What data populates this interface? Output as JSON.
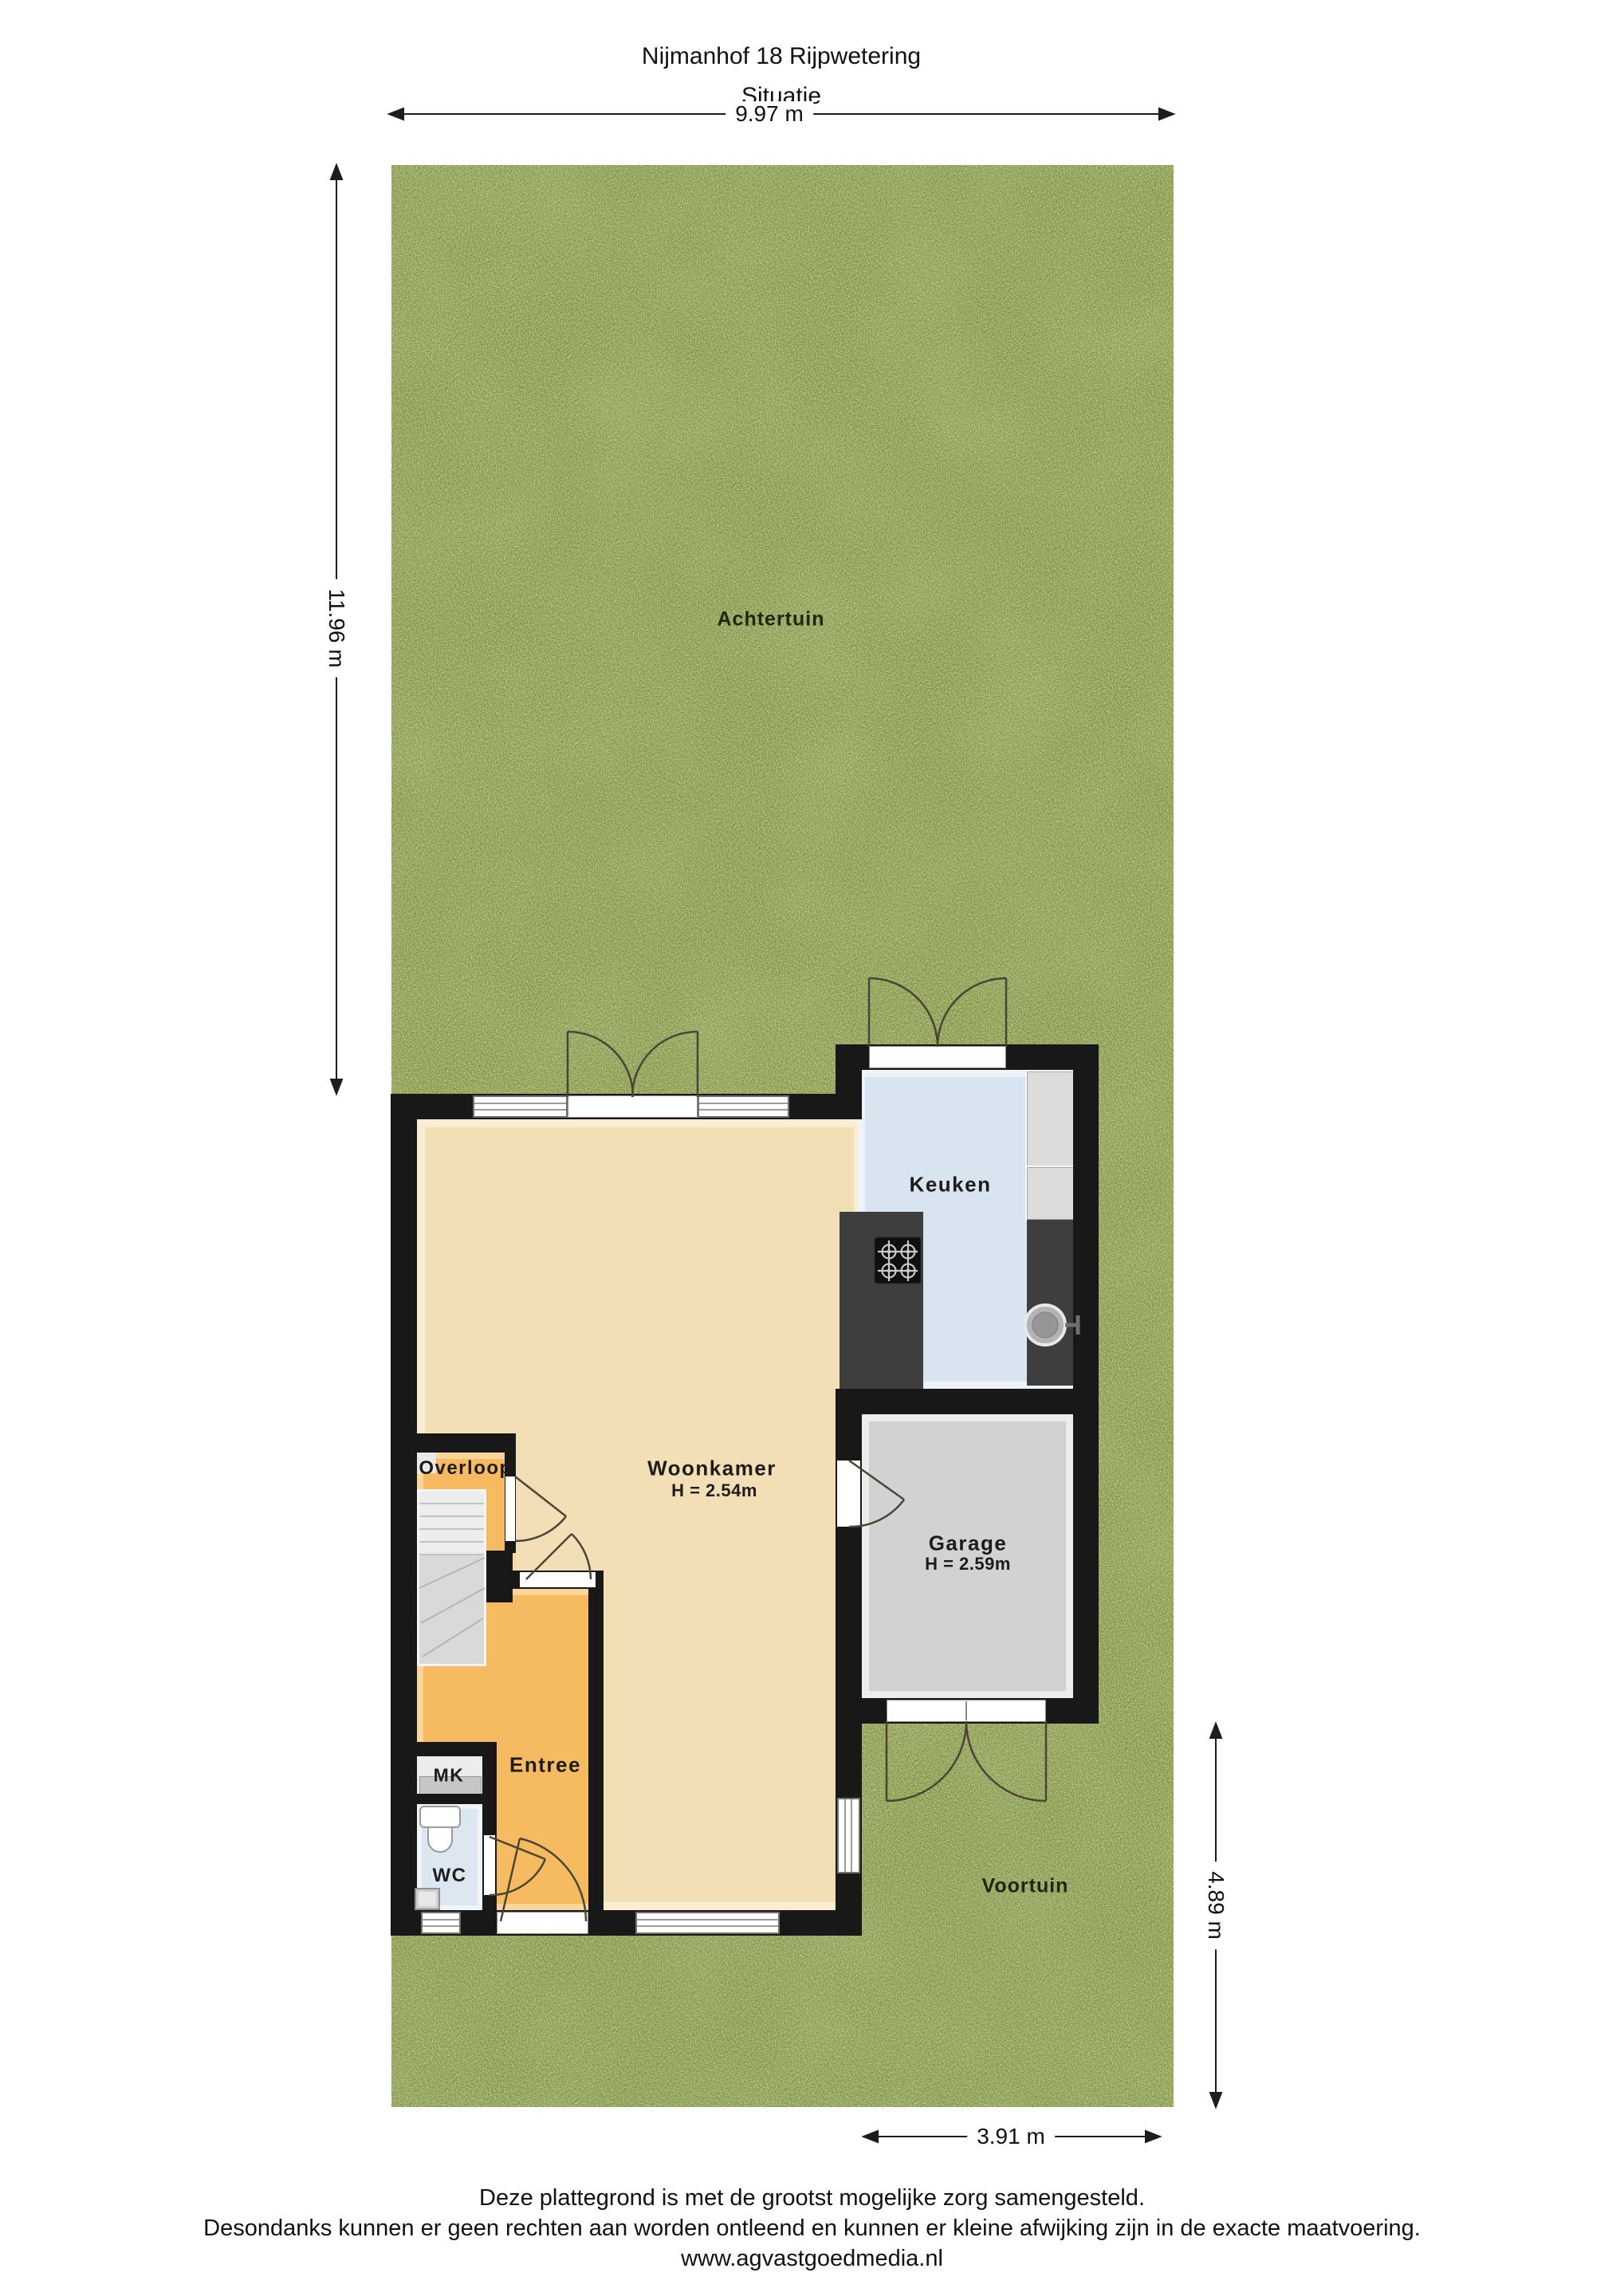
{
  "title": {
    "line1": "Nijmanhof 18 Rijpwetering",
    "line2": "Situatie"
  },
  "dimensions": {
    "top": "9.97 m",
    "left": "11.96 m",
    "right": "4.89 m",
    "bottom": "3.91 m"
  },
  "areas": {
    "back_garden": "Achtertuin",
    "front_garden": "Voortuin"
  },
  "rooms": {
    "kitchen": {
      "name": "Keuken"
    },
    "living_room": {
      "name": "Woonkamer",
      "height": "H = 2.54m"
    },
    "garage": {
      "name": "Garage",
      "height": "H = 2.59m"
    },
    "landing": {
      "name": "Overloop"
    },
    "hall": {
      "name": "Entree"
    },
    "meter_cupboard": {
      "name": "MK"
    },
    "toilet": {
      "name": "WC"
    }
  },
  "footer": {
    "line1": "Deze plattegrond is met de grootst mogelijke zorg samengesteld.",
    "line2": "Desondanks kunnen er geen rechten aan worden ontleend en kunnen er kleine afwijking zijn in de exacte maatvoering.",
    "line3": "www.agvastgoedmedia.nl"
  },
  "colors": {
    "wall": "#181818",
    "grass_base": "#7a8e41",
    "living": "#f2dfb6",
    "hall": "#f6ba60",
    "kitchen": "#d8e4f0",
    "garage": "#d2d2d2",
    "wc": "#dce7f1",
    "mk": "#ececec",
    "counter": "#3e3e3e",
    "cabinet": "#dcdcdc",
    "window_frame": "#9c9c9c",
    "arc": "#4a4536",
    "dim_line": "#1d1d1d"
  }
}
